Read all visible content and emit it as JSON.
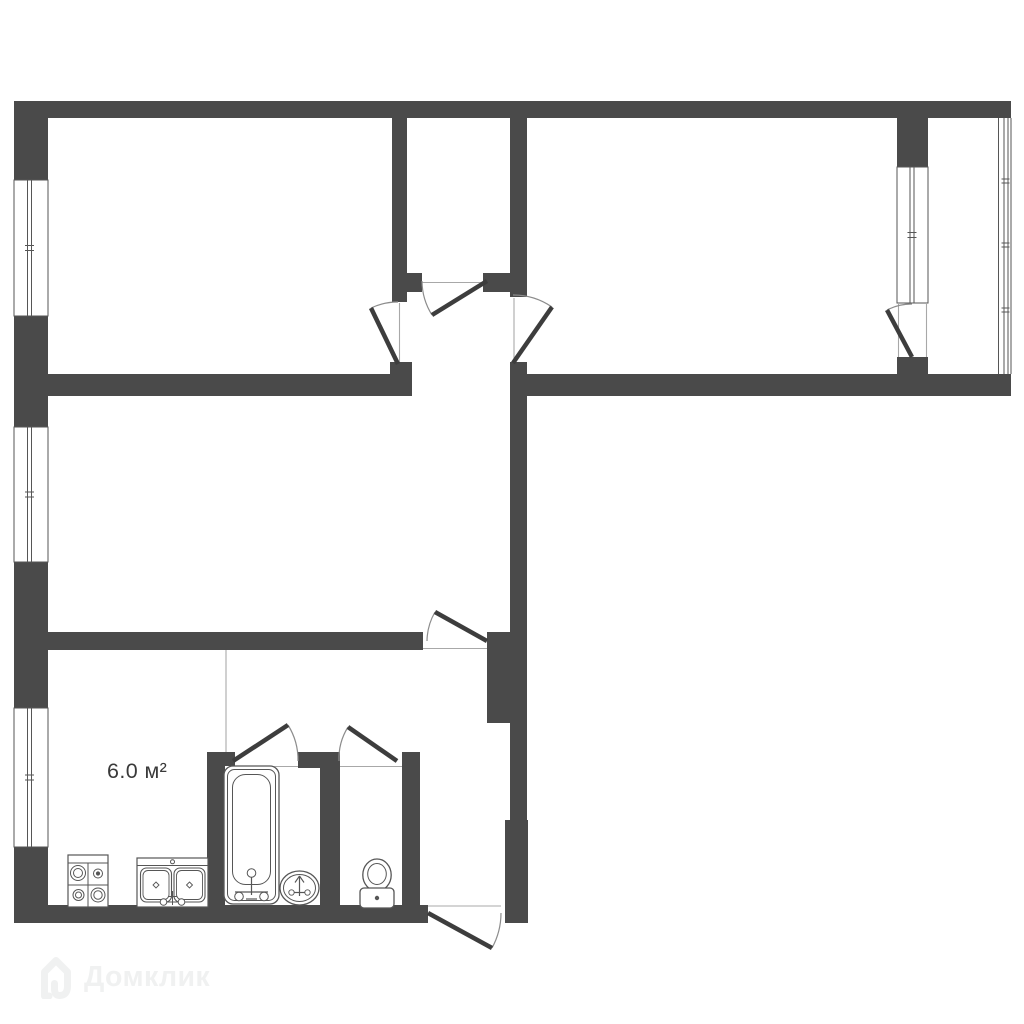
{
  "colors": {
    "bg": "#ffffff",
    "wall": "#4a4a4a",
    "stroke": "#565656",
    "leaf": "#3d3d3d",
    "arc": "#8c8c8c",
    "thin": "#a8a8a8",
    "label": "#3a3a3a",
    "watermark": "#f0f1f1"
  },
  "labels": {
    "kitchen_area": "6.0 м²"
  },
  "watermark": {
    "text": "Домклик"
  },
  "plan": {
    "walls": [
      [
        "top-wall",
        14,
        101,
        997,
        17
      ],
      [
        "left-wall-a",
        14,
        101,
        34,
        79
      ],
      [
        "left-wall-b",
        14,
        316,
        34,
        111
      ],
      [
        "left-wall-c",
        14,
        562,
        34,
        146
      ],
      [
        "left-wall-d",
        14,
        847,
        34,
        76
      ],
      [
        "bottom-wall",
        14,
        905,
        414,
        18
      ],
      [
        "right-wall-upper",
        510,
        396,
        17,
        424
      ],
      [
        "right-wall-lower",
        505,
        820,
        23,
        103
      ],
      [
        "mid-wall-left",
        48,
        374,
        342,
        22
      ],
      [
        "room1-door-jamb",
        390,
        362,
        22,
        34
      ],
      [
        "mid-wall-right",
        527,
        374,
        484,
        22
      ],
      [
        "vestibule-left-wall",
        392,
        118,
        15,
        184
      ],
      [
        "vestibule-right-wall",
        510,
        118,
        17,
        179
      ],
      [
        "vestibule-right-wall-lower",
        510,
        362,
        17,
        34
      ],
      [
        "vestibule-south-jamb-left",
        407,
        273,
        15,
        19
      ],
      [
        "vestibule-south-jamb-right",
        483,
        273,
        27,
        19
      ],
      [
        "living-room-south-wall",
        48,
        632,
        375,
        18
      ],
      [
        "hall-corner-block",
        487,
        632,
        23,
        91
      ],
      [
        "balcony-partition-top",
        897,
        118,
        31,
        49
      ],
      [
        "balcony-partition-stub",
        897,
        357,
        31,
        39
      ],
      [
        "bathroom-left-wall",
        207,
        752,
        18,
        156
      ],
      [
        "bathroom-door-jamb",
        225,
        752,
        10,
        14
      ],
      [
        "bath-toilet-front-wall",
        298,
        752,
        42,
        16
      ],
      [
        "bath-toilet-divider-wall",
        320,
        752,
        20,
        156
      ],
      [
        "toilet-right-wall",
        402,
        752,
        18,
        156
      ]
    ],
    "windows": [
      {
        "name": "window-room1",
        "x": 14,
        "y": 180,
        "w": 34,
        "h": 136,
        "g": [
          13.5,
          17.5
        ]
      },
      {
        "name": "window-living",
        "x": 14,
        "y": 427,
        "w": 34,
        "h": 135,
        "g": [
          13.5,
          17.5
        ]
      },
      {
        "name": "window-kitchen",
        "x": 14,
        "y": 708,
        "w": 34,
        "h": 139,
        "g": [
          13.5,
          17.5
        ]
      },
      {
        "name": "window-balcony-partition",
        "x": 897,
        "y": 167,
        "w": 31,
        "h": 136,
        "g": [
          13,
          17
        ]
      }
    ],
    "loggia_glazing": {
      "name": "loggia-glazing",
      "xs": [
        998.5,
        1004,
        1008,
        1011
      ],
      "y1": 118,
      "y2": 374,
      "tick_ys": [
        181,
        245,
        310
      ],
      "tx1": 1001.5,
      "tx2": 1009.5
    },
    "doors": [
      {
        "name": "room1-door",
        "hinge": [
          398,
          364
        ],
        "free": [
          371,
          308
        ],
        "closed": [
          398,
          302
        ],
        "sweep": 0
      },
      {
        "name": "room2-door",
        "hinge": [
          513,
          363
        ],
        "free": [
          552,
          307
        ],
        "closed": [
          513,
          295
        ],
        "sweep": 1
      },
      {
        "name": "vestibule-door",
        "hinge": [
          487,
          281
        ],
        "free": [
          432,
          315
        ],
        "closed": [
          422,
          281
        ],
        "sweep": 0
      },
      {
        "name": "living-room-door",
        "hinge": [
          487,
          641
        ],
        "free": [
          435,
          612
        ],
        "closed": [
          427,
          641
        ],
        "sweep": 1
      },
      {
        "name": "balcony-door",
        "hinge": [
          912,
          357
        ],
        "free": [
          887,
          310
        ],
        "closed": [
          912,
          304
        ],
        "sweep": 0
      },
      {
        "name": "bathroom-door",
        "hinge": [
          233,
          761
        ],
        "free": [
          288,
          725
        ],
        "closed": [
          298,
          761
        ],
        "sweep": 0
      },
      {
        "name": "toilet-door",
        "hinge": [
          397,
          761
        ],
        "free": [
          348,
          727
        ],
        "closed": [
          339,
          761
        ],
        "sweep": 1
      },
      {
        "name": "entrance-door",
        "hinge": [
          428,
          913
        ],
        "free": [
          492,
          948
        ],
        "closed": [
          501,
          913
        ],
        "sweep": 1
      }
    ],
    "thin_lines": [
      [
        "kitchen-boundary-line",
        226,
        650,
        226,
        752
      ],
      [
        "room1-door-threshold",
        399.5,
        303,
        399.5,
        362
      ],
      [
        "room2-door-threshold",
        514,
        298,
        514,
        361
      ],
      [
        "vestibule-door-threshold",
        422,
        282.5,
        483,
        282.5
      ],
      [
        "living-room-door-threshold",
        423,
        648.5,
        487,
        648.5
      ],
      [
        "entrance-door-threshold",
        428,
        906,
        501,
        906
      ],
      [
        "bathroom-door-threshold",
        235,
        766.5,
        298,
        766.5
      ],
      [
        "toilet-door-threshold",
        340,
        766.5,
        402,
        766.5
      ],
      [
        "balcony-door-frame-left",
        898.5,
        303,
        898.5,
        357
      ],
      [
        "balcony-door-frame-right",
        926.5,
        303,
        926.5,
        357
      ]
    ],
    "fixtures": [
      {
        "type": "stove",
        "name": "stove",
        "x": 68,
        "y": 855,
        "w": 40,
        "h": 52
      },
      {
        "type": "kitchen-sink",
        "name": "kitchen-sink",
        "x": 137,
        "y": 858,
        "w": 71,
        "h": 49
      },
      {
        "type": "bathtub",
        "name": "bathtub",
        "x": 224,
        "y": 766,
        "w": 55,
        "h": 138
      },
      {
        "type": "washbasin",
        "name": "washbasin",
        "x": 280,
        "y": 871,
        "w": 39,
        "h": 34
      },
      {
        "type": "toilet",
        "name": "toilet",
        "x": 360,
        "y": 858,
        "w": 34,
        "h": 50
      }
    ]
  }
}
